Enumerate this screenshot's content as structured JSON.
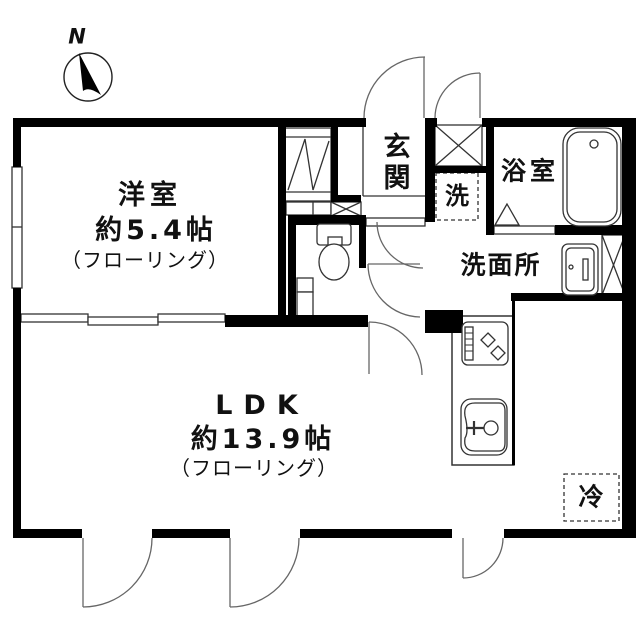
{
  "floorplan": {
    "compass": {
      "label": "N"
    },
    "rooms": {
      "western_room": {
        "name": "洋室",
        "size": "約5.4帖",
        "floor": "（フローリング）"
      },
      "ldk": {
        "name": "LDK",
        "size": "約13.9帖",
        "floor": "（フローリング）"
      },
      "entrance": {
        "name": "玄関"
      },
      "washer": {
        "name": "洗"
      },
      "bathroom": {
        "name": "浴室"
      },
      "washroom": {
        "name": "洗面所"
      },
      "refrigerator": {
        "name": "冷"
      }
    },
    "fixtures": [
      "compass-icon",
      "bathtub-icon",
      "toilet-icon",
      "washbasin-icon",
      "gas-stove-icon",
      "kitchen-sink-icon"
    ],
    "colors": {
      "wall": "#000000",
      "background": "#ffffff",
      "thin_line": "#333333",
      "door_line": "#666666",
      "text": "#111111"
    }
  }
}
